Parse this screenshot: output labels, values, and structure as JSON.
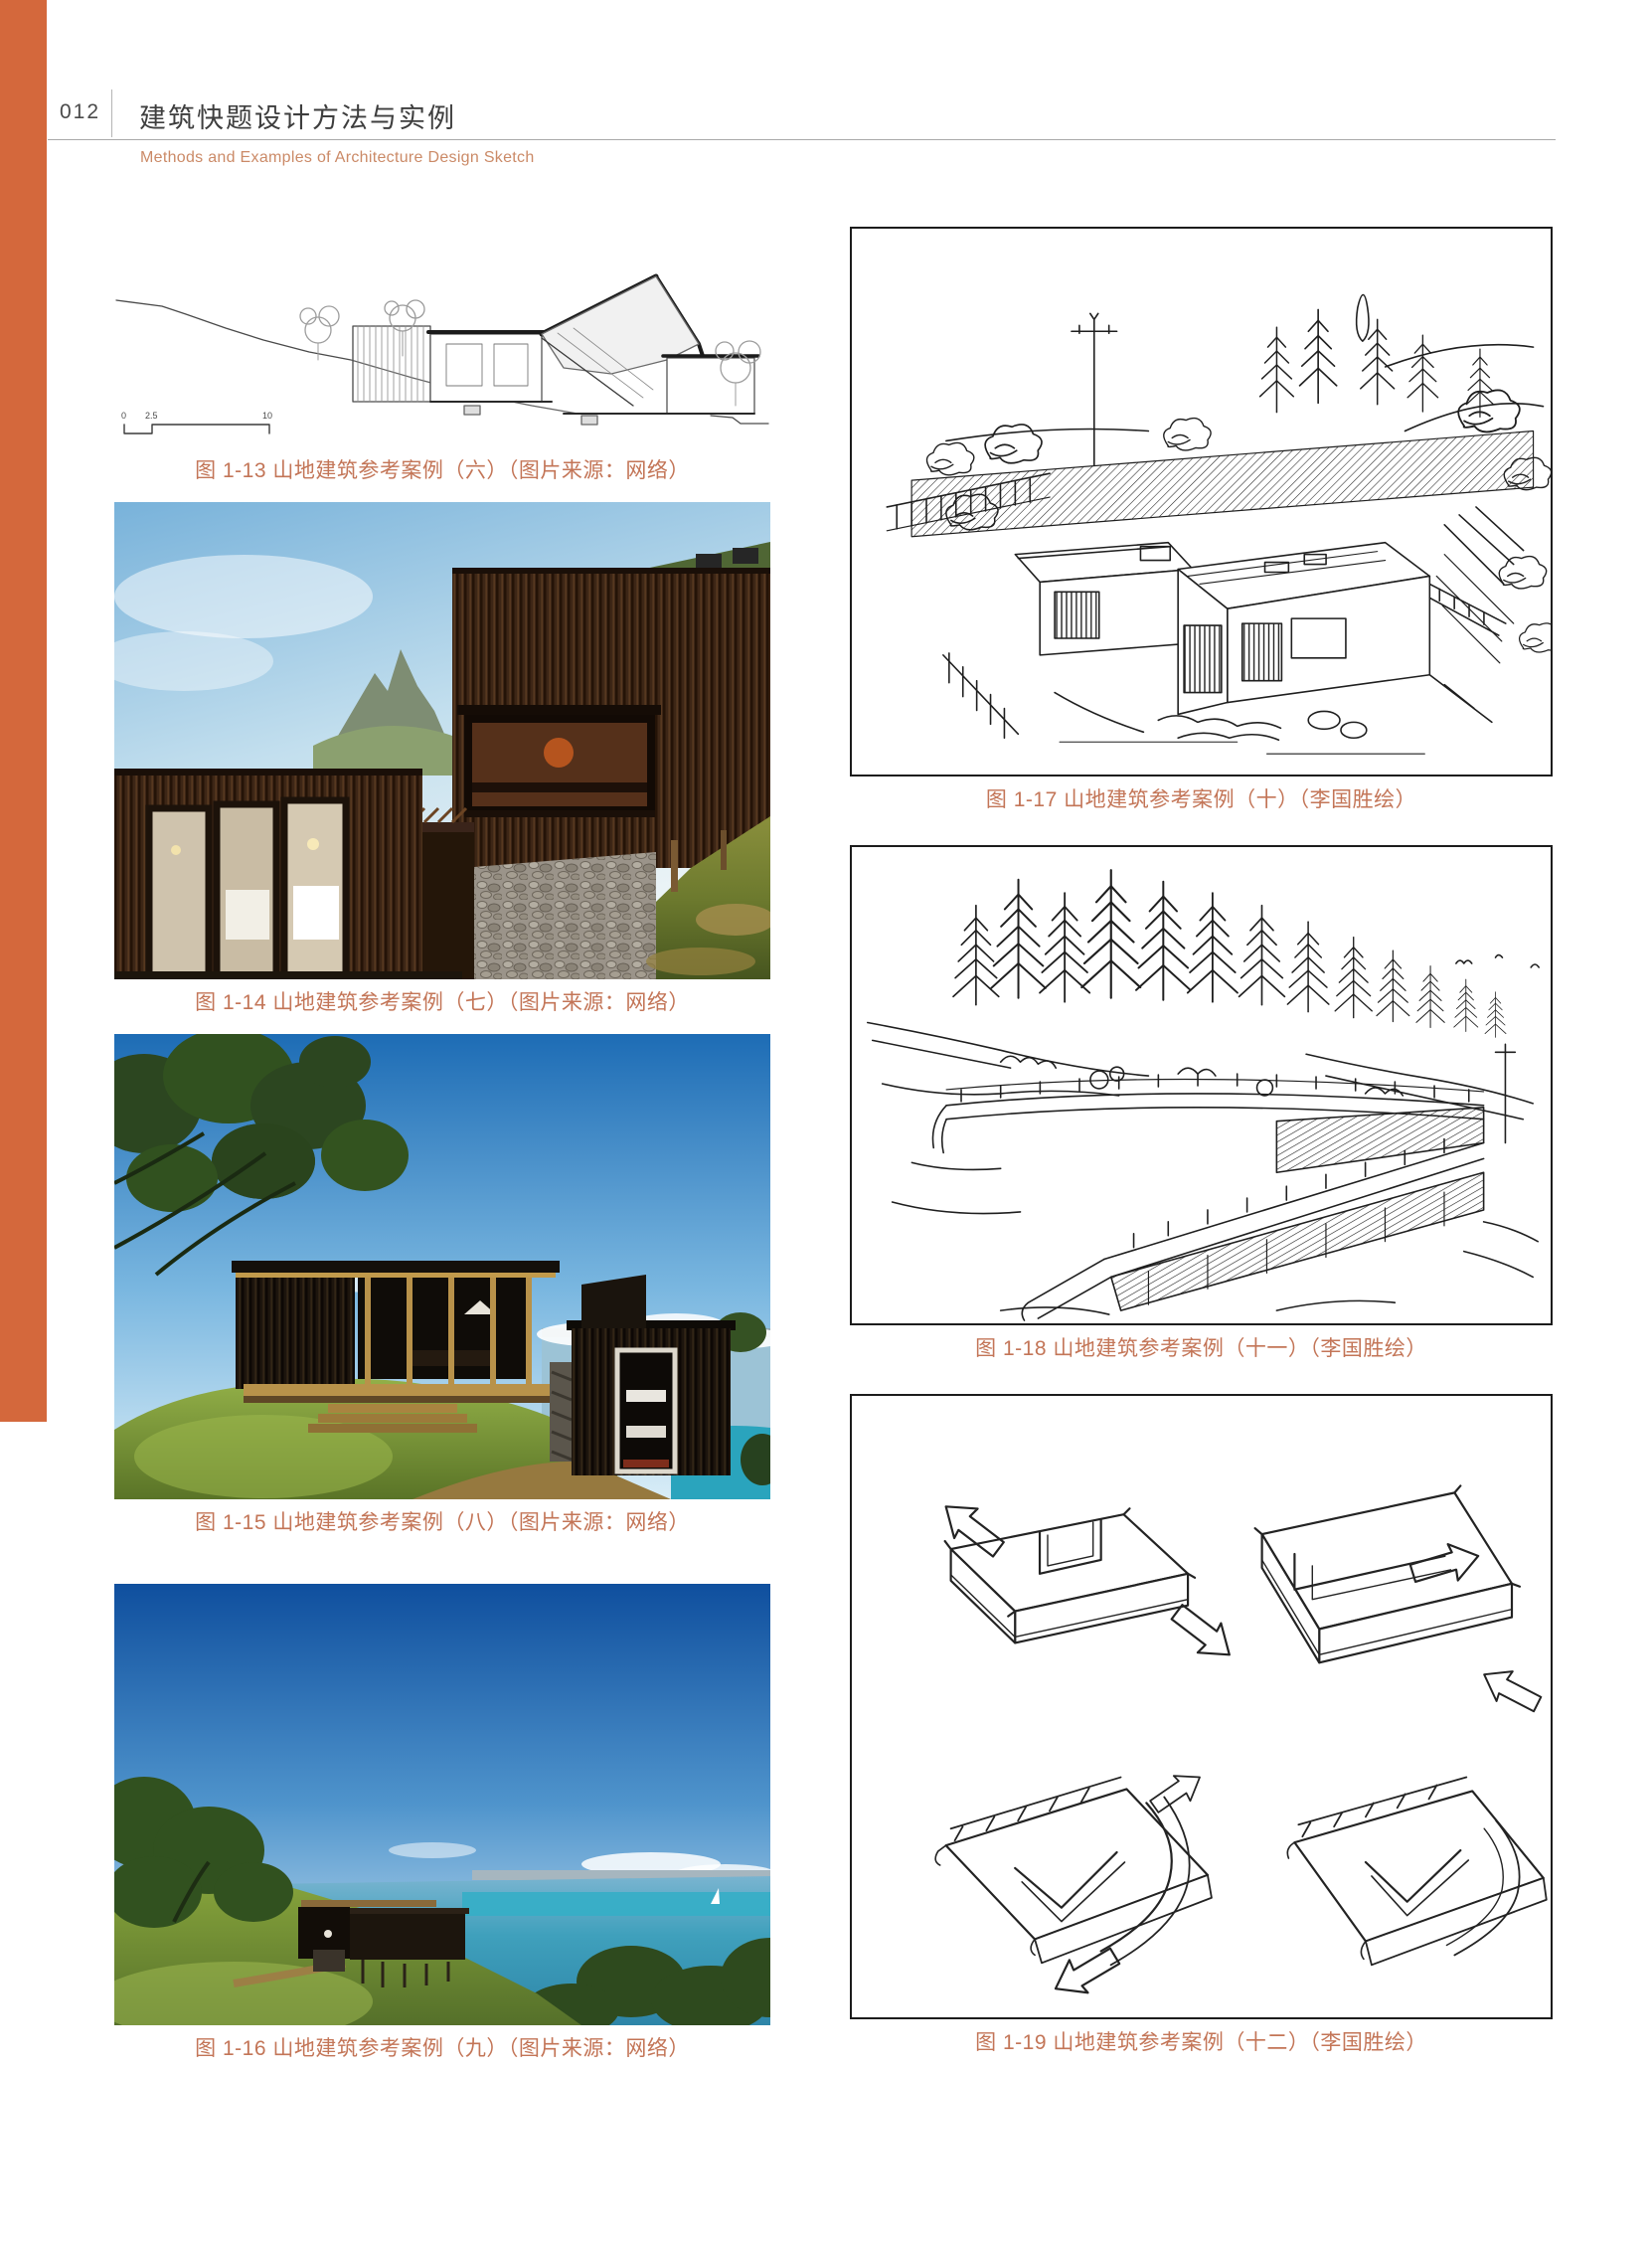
{
  "header": {
    "page_number": "012",
    "title_zh": "建筑快题设计方法与实例",
    "title_en": "Methods and Examples of Architecture Design Sketch"
  },
  "colors": {
    "accent_bar": "#d4683c",
    "caption_text": "#c37557",
    "header_title": "#3e3e3e",
    "header_subtitle": "#cb8a67",
    "sketch_border": "#1c1c1c"
  },
  "figures": {
    "left": [
      {
        "caption": "图 1-13 山地建筑参考案例（六）（图片来源：网络）",
        "content": "hillside house section line drawing",
        "scale_labels": [
          "0",
          "2.5",
          "10"
        ]
      },
      {
        "caption": "图 1-14 山地建筑参考案例（七）（图片来源：网络）",
        "content": "photo: dark timber slat house with stone gabion base on grassy slope"
      },
      {
        "caption": "图 1-15 山地建筑参考案例（八）（图片来源：网络）",
        "content": "photo: timber pavilion and black cabin on coastal hilltop"
      },
      {
        "caption": "图 1-16 山地建筑参考案例（九）（图片来源：网络）",
        "content": "photo: dark cabin on green headland above turquoise sea"
      }
    ],
    "right": [
      {
        "caption": "图 1-17 山地建筑参考案例（十）（李国胜绘）",
        "content": "ink sketch: flat-roofed houses on planted hillside"
      },
      {
        "caption": "图 1-18 山地建筑参考案例（十一）（李国胜绘）",
        "content": "ink sketch: terraced building below row of pines"
      },
      {
        "caption": "图 1-19 山地建筑参考案例（十二）（李国胜绘）",
        "content": "ink sketch: four massing diagrams with flow arrows"
      }
    ]
  }
}
